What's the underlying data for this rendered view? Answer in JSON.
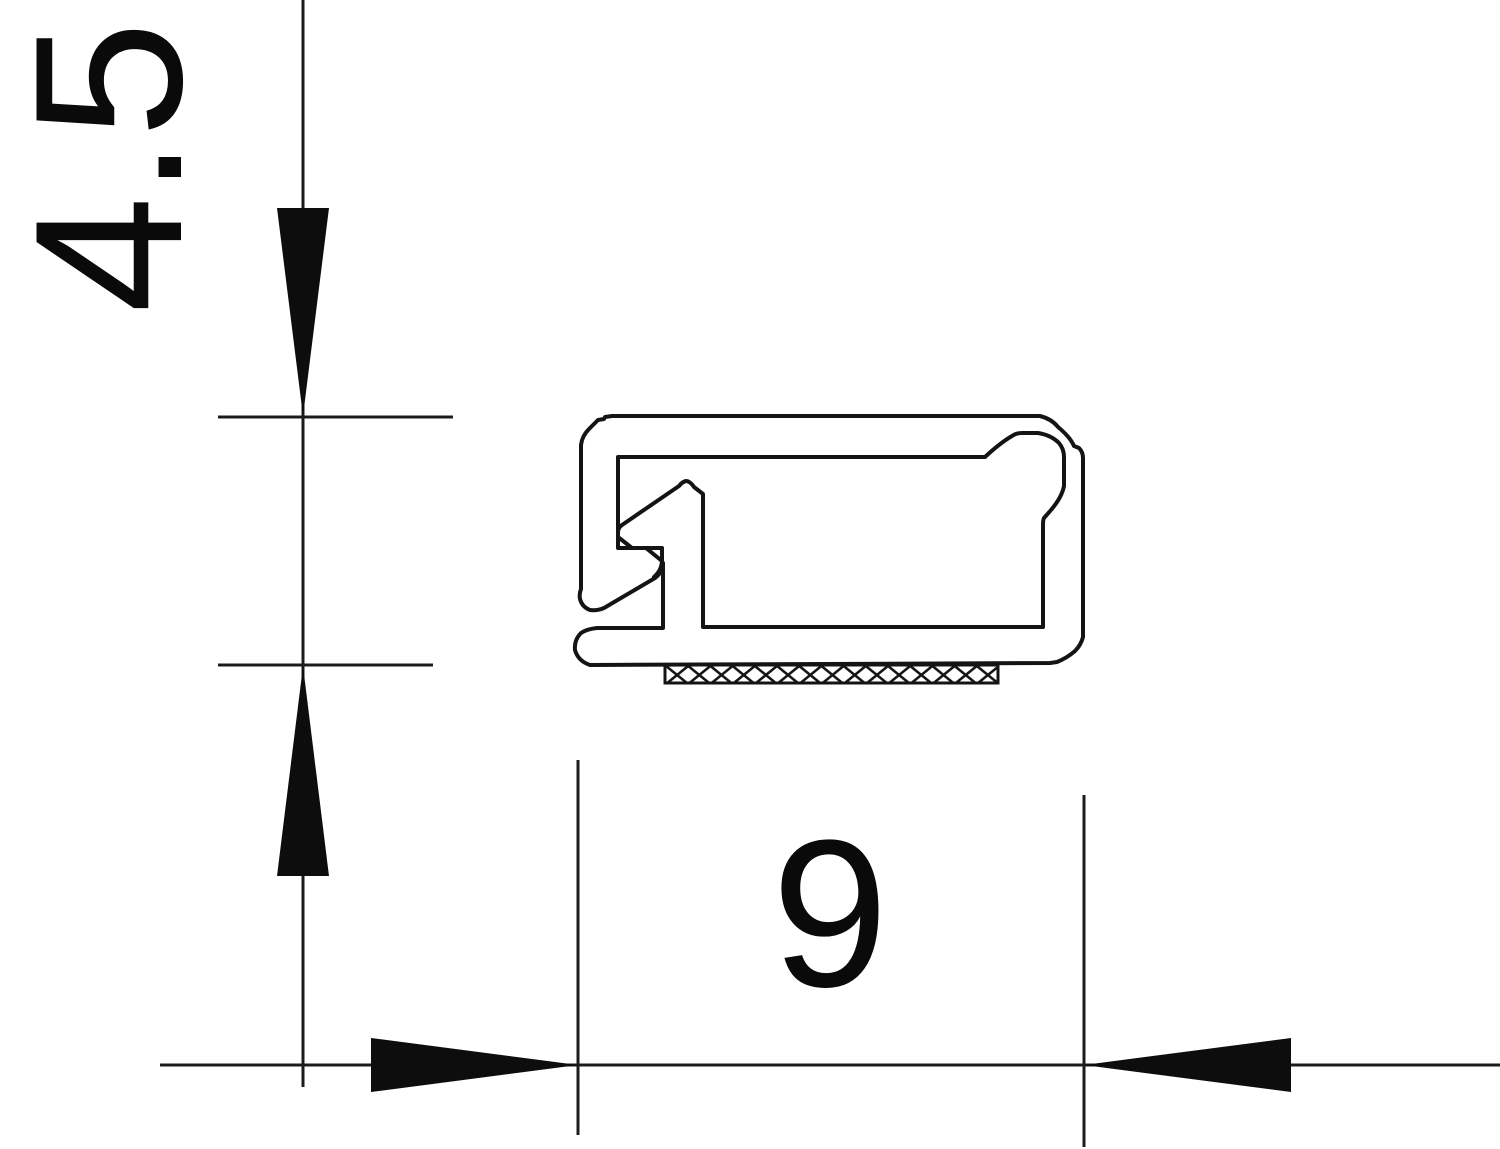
{
  "drawing": {
    "background": "#ffffff",
    "ink_color": "#141414",
    "dimensions": {
      "height": {
        "label": "4.5",
        "orientation": "vertical"
      },
      "width": {
        "label": "9",
        "orientation": "horizontal"
      }
    }
  }
}
